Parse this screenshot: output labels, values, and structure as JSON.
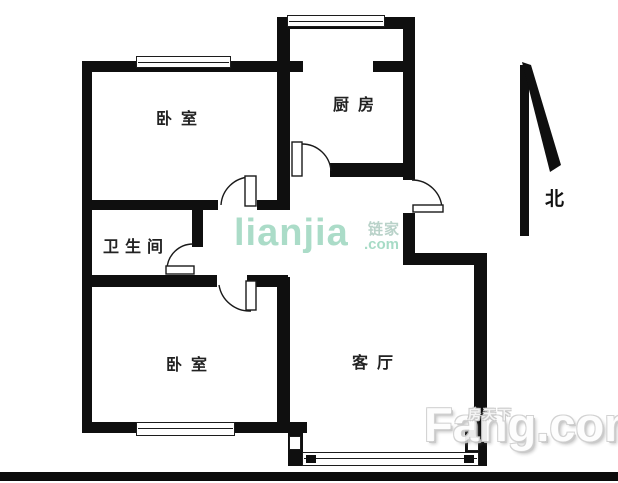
{
  "floorplan": {
    "type": "apartment-floor-plan",
    "rooms": [
      {
        "id": "bedroom-north",
        "label": "卧室"
      },
      {
        "id": "kitchen",
        "label": "厨房"
      },
      {
        "id": "bathroom",
        "label": "卫生间"
      },
      {
        "id": "bedroom-south",
        "label": "卧室"
      },
      {
        "id": "living-room",
        "label": "客厅"
      }
    ],
    "compass": {
      "label": "北"
    }
  },
  "watermarks": {
    "lianjia": {
      "logo": "LIANJIA",
      "cjk": "链家",
      "tld": ".com",
      "color": "#abdcc8"
    },
    "fang": {
      "cjk": "房天下",
      "logo": "Fang.com"
    }
  },
  "colors": {
    "wall": "#0f0f0f",
    "background": "#ffffff",
    "label_text": "#222222",
    "lianjia_green": "#abdcc8"
  }
}
